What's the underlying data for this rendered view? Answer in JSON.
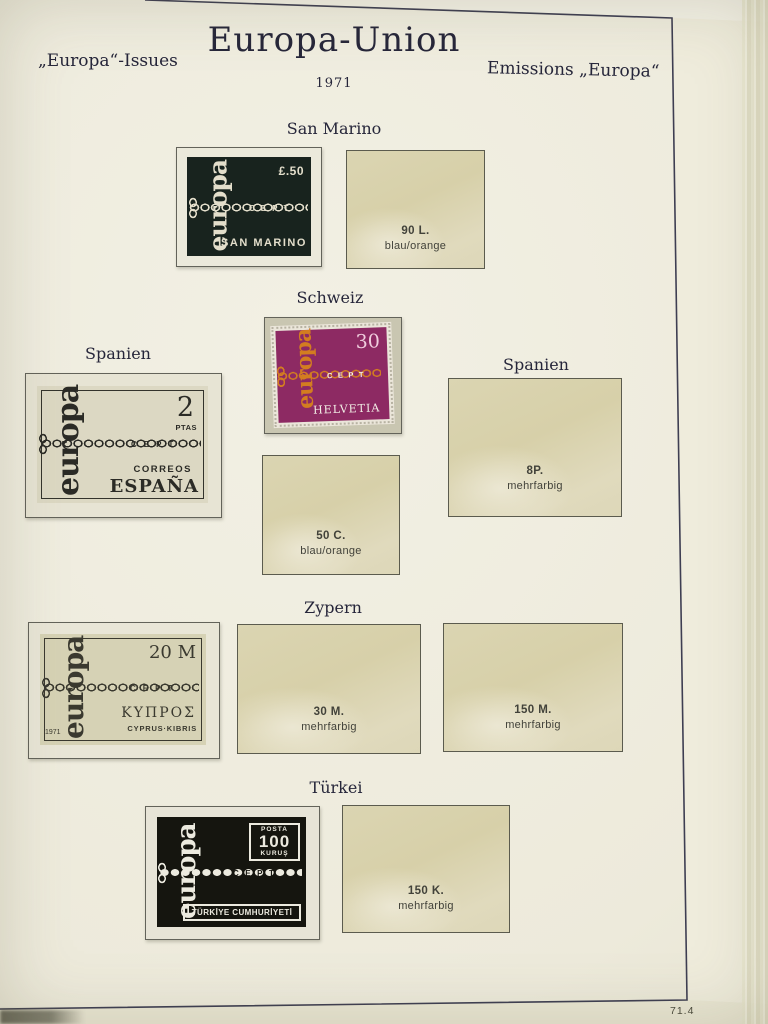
{
  "page": {
    "title": "Europa-Union",
    "year": "1971",
    "top_left_label": "„Europa“-Issues",
    "top_right_label": "Emissions „Europa“",
    "page_number": "71.4"
  },
  "sections": {
    "san_marino": {
      "heading": "San Marino",
      "stamp": {
        "europa": "europa",
        "value": "£.50",
        "cept": "CEPT",
        "country": "SAN MARINO"
      },
      "placeholder": {
        "value": "90 L.",
        "color_note": "blau/orange"
      }
    },
    "schweiz": {
      "heading": "Schweiz",
      "stamp": {
        "europa": "europa",
        "value": "30",
        "cept": "CEPT",
        "country": "HELVETIA"
      },
      "placeholder": {
        "value": "50 C.",
        "color_note": "blau/orange"
      }
    },
    "spanien_left": {
      "heading": "Spanien",
      "stamp": {
        "europa": "europa",
        "value": "2",
        "value_unit": "PTAS",
        "cept": "CEPT",
        "country_line1": "CORREOS",
        "country_line2": "ESPAÑA"
      }
    },
    "spanien_right": {
      "heading": "Spanien",
      "placeholder": {
        "value": "8P.",
        "color_note": "mehrfarbig"
      }
    },
    "zypern": {
      "heading": "Zypern",
      "stamp": {
        "europa": "europa",
        "value": "20 M",
        "cept": "CEPT",
        "country_line1": "ΚΥΠΡΟΣ",
        "country_line2": "CYPRUS·KIBRIS",
        "year": "1971"
      },
      "placeholders": [
        {
          "value": "30 M.",
          "color_note": "mehrfarbig"
        },
        {
          "value": "150 M.",
          "color_note": "mehrfarbig"
        }
      ]
    },
    "tuerkei": {
      "heading": "Türkei",
      "stamp": {
        "europa": "europa",
        "posta": "POSTA",
        "value": "100",
        "value_unit": "KURUŞ",
        "cept": "CEPT",
        "country": "TÜRKİYE CUMHURİYETİ"
      },
      "placeholder": {
        "value": "150 K.",
        "color_note": "mehrfarbig"
      }
    }
  },
  "colors": {
    "page_background": "#edeadb",
    "frame_line": "#3e3e52",
    "heading_text": "#26263a",
    "placeholder_bg": "#d9d3b0",
    "placeholder_text": "#42423a",
    "stamp_san_marino": "#18231e",
    "stamp_san_marino_ink": "#e3decb",
    "stamp_schweiz": "#8d2a63",
    "stamp_schweiz_chain": "#d37d20",
    "stamp_spanien": "#dcd8c3",
    "stamp_spanien_ink": "#2b2b26",
    "stamp_zypern": "#d6d2b5",
    "stamp_zypern_ink": "#3a392f",
    "stamp_tuerkei": "#15150f",
    "stamp_tuerkei_ink": "#eceadf"
  }
}
